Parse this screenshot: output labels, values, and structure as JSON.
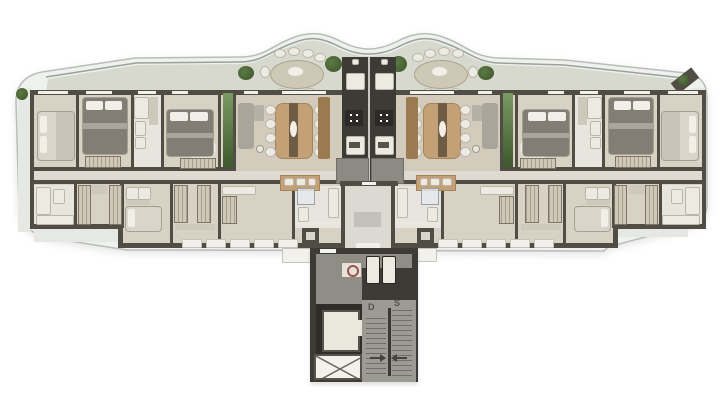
{
  "meta": {
    "title": "Residential floor plan — typical floor, two mirrored apartments around a central elevator and stair core",
    "style": "3D top-down architectural render on white background"
  },
  "palette": {
    "shell_fill": "#eff1ee",
    "shell_stroke": "#b9bdb7",
    "railing": "#9aa09b",
    "terrace_floor": "#d7d9cf",
    "walkway": "#e6e8e3",
    "wall_dark": "#504d44",
    "wall_light": "#eae9e1",
    "floor_main": "#d8d2c4",
    "floor_warm": "#d3ccbd",
    "floor_light": "#dfdbd0",
    "floor_bath": "#e7e5de",
    "wood": "#c3a076",
    "wood_dark": "#9a7b52",
    "runner": "#6e5c44",
    "bed_light": "#d9d5ca",
    "bed_dark": "#827d75",
    "duvet_fold": "#aaa59b",
    "pillow": "#f1efe8",
    "sofa": "#a9a59a",
    "chair_fill": "#edebe3",
    "plant_light": "#5d7a45",
    "plant_dark": "#3c5429",
    "green_wall": "#7b9a63",
    "core_dark": "#3c3b36",
    "core_floor": "#8e8d86",
    "stair_floor": "#9b9a93",
    "tread": "#6f6e67",
    "cab_floor": "#eae7dc",
    "shaft_white": "#f2f1eb",
    "appliance": "#eceae1",
    "island": "#8b8b84",
    "ledge": "#f2f1ec",
    "label": "#55544c",
    "hose_red": "#a0524a",
    "fixture_border": "#b9b6ab",
    "counter": "#cfc9bc"
  },
  "core": {
    "stairs": {
      "down_label": "D",
      "up_label": "S"
    },
    "elements": [
      "elevator-cab",
      "ventilation-shaft-x",
      "scissor-stair",
      "fire-hose-cabinet",
      "service-ducts",
      "entry-landing"
    ]
  },
  "terrace": {
    "oval_tables": 2,
    "chairs_per_table": 8,
    "planters": [
      "left-end",
      "left-of-left-table",
      "left-of-core",
      "right-of-core",
      "right-of-right-table",
      "top-right-corner-bench"
    ]
  },
  "apartment": {
    "rooms": [
      "bedroom-1",
      "bedroom-2",
      "bathroom",
      "master-suite",
      "living-dining",
      "kitchen",
      "service-bathroom",
      "closet",
      "laundry",
      "service-bedroom",
      "storage",
      "front-terrace"
    ],
    "furniture": [
      "double-bed",
      "wardrobe",
      "dining-table-8-chairs",
      "sofa",
      "tv-sideboard",
      "kitchen-island",
      "cooktop",
      "oven",
      "refrigerator",
      "balcony-counter"
    ]
  }
}
